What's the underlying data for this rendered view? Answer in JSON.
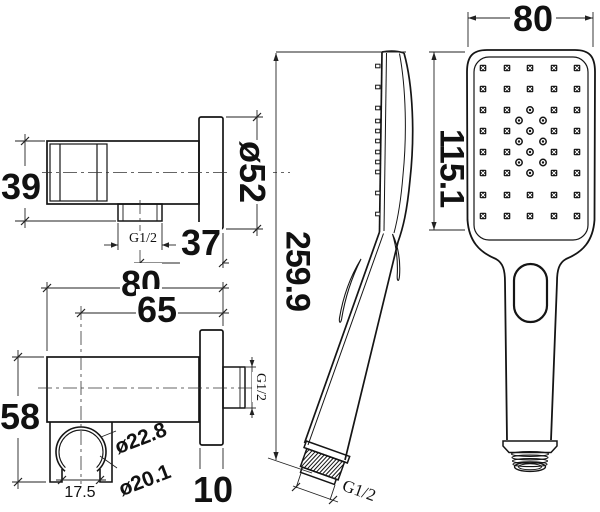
{
  "drawing_colors": {
    "line": "#151515",
    "dim_line": "#222222",
    "background": "#ffffff"
  },
  "outlet_side": {
    "height": "39",
    "flange_diameter": "ø52",
    "offset": "37",
    "thread": "G1/2"
  },
  "outlet_top": {
    "width": "80",
    "center_distance": "65",
    "height": "58",
    "clip_outer_diameter": "ø22.8",
    "clip_inner_diameter": "ø20.1",
    "clip_gap": "17.5",
    "flange_thickness": "10",
    "thread": "G1/2"
  },
  "handset_side": {
    "length": "259.9",
    "thread": "G1/2",
    "nub_rows": [
      66,
      87,
      108,
      121,
      131,
      141,
      152,
      162,
      172,
      193,
      214
    ]
  },
  "handset_front": {
    "width": "80",
    "face_length": "115.1",
    "nozzle_grid": {
      "cols": [
        483,
        507,
        530,
        554,
        577
      ],
      "rows": [
        68,
        89,
        110,
        131,
        152,
        173,
        195,
        216
      ],
      "skip_col": 530,
      "skip_rows": [
        110,
        131,
        152,
        173
      ],
      "circles": [
        [
          530,
          110
        ],
        [
          530,
          131
        ],
        [
          530,
          152
        ],
        [
          530,
          173
        ],
        [
          519,
          120.5
        ],
        [
          543,
          120.5
        ],
        [
          519,
          141.5
        ],
        [
          543,
          141.5
        ],
        [
          519,
          162.5
        ],
        [
          543,
          162.5
        ]
      ]
    }
  }
}
